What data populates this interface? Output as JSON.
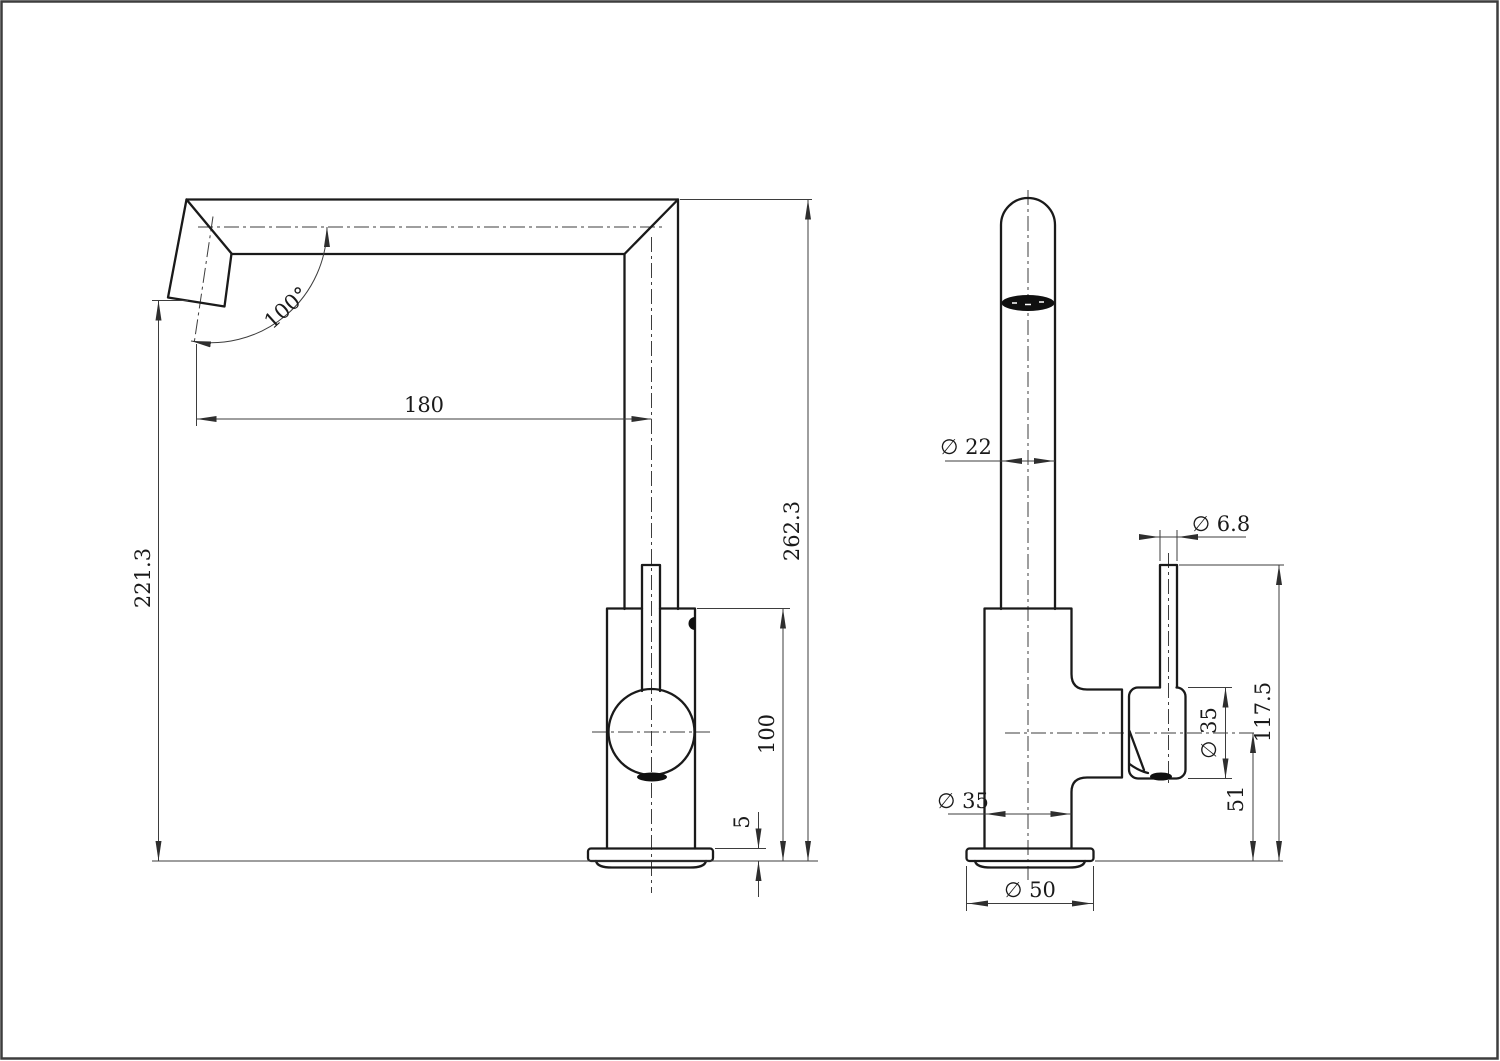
{
  "sheet": {
    "background": "#ffffff",
    "border_color": "#3d3d3d",
    "outline_color": "#1a1a1a",
    "dim_color": "#3d3d3d"
  },
  "views": {
    "side_view": {
      "dims": {
        "spout_angle": "100°",
        "spout_reach": "180",
        "spout_outlet_height": "221.3",
        "overall_height": "262.3",
        "body_height": "100",
        "base_thickness": "5"
      }
    },
    "front_view": {
      "dims": {
        "spout_tube_diameter": "∅ 22",
        "lever_rod_diameter": "∅ 6.8",
        "lever_top_height": "117.5",
        "handle_diameter": "∅ 35",
        "cartridge_axis_height": "51",
        "body_diameter": "∅ 35",
        "base_diameter": "∅ 50"
      }
    }
  }
}
